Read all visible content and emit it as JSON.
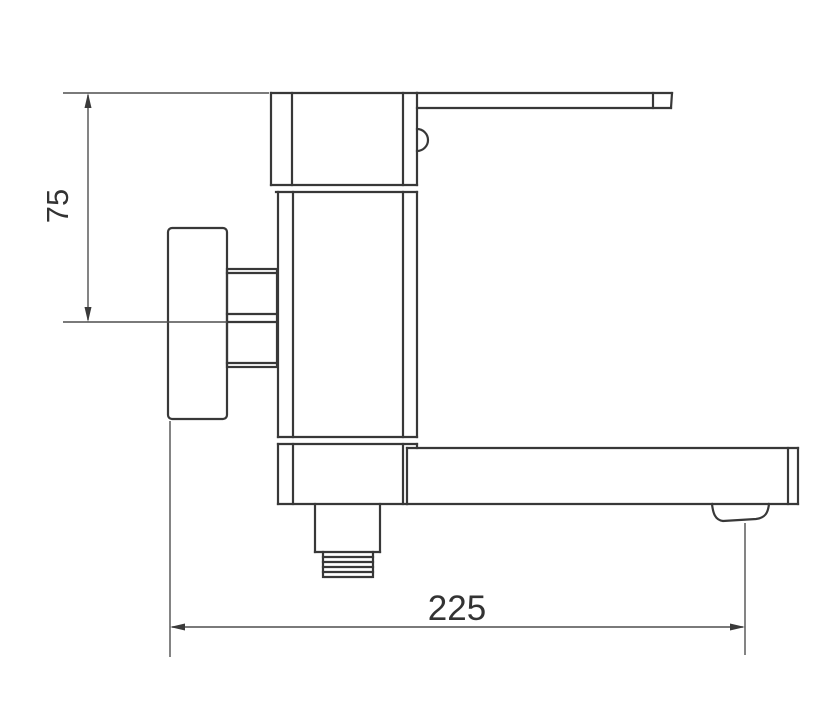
{
  "drawing": {
    "dimensions": {
      "height_offset": {
        "value": "75",
        "orientation": "vertical"
      },
      "spout_reach": {
        "value": "225",
        "orientation": "horizontal"
      }
    },
    "colors": {
      "background": "#ffffff",
      "outline": "#383838",
      "dimension_lines": "#4f4f4f",
      "text": "#333333"
    }
  }
}
